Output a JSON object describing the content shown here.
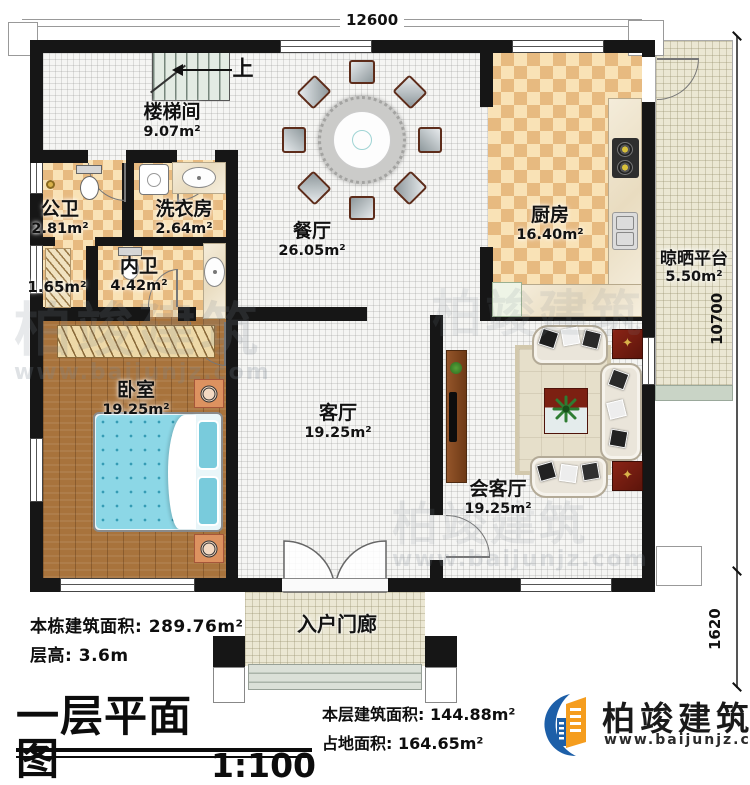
{
  "plan": {
    "title": "一层平面图",
    "scale": "1:100",
    "stairs_up": "上"
  },
  "dimensions": {
    "top": "12600",
    "right": "10700",
    "bottom_right": "1620"
  },
  "rooms": {
    "stairwell": {
      "name": "楼梯间",
      "area": "9.07m²"
    },
    "public_bath": {
      "name": "公卫",
      "area": "2.81m²"
    },
    "laundry": {
      "name": "洗衣房",
      "area": "2.64m²"
    },
    "closet": {
      "area": "1.65m²"
    },
    "ensuite_bath": {
      "name": "内卫",
      "area": "4.42m²"
    },
    "dining": {
      "name": "餐厅",
      "area": "26.05m²"
    },
    "kitchen": {
      "name": "厨房",
      "area": "16.40m²"
    },
    "drying_platform": {
      "name": "晾晒平台",
      "area": "5.50m²"
    },
    "bedroom": {
      "name": "卧室",
      "area": "19.25m²"
    },
    "living": {
      "name": "客厅",
      "area": "19.25m²"
    },
    "reception": {
      "name": "会客厅",
      "area": "19.25m²"
    },
    "porch": {
      "name": "入户门廊"
    }
  },
  "stats": {
    "building_area_label": "本栋建筑面积:",
    "building_area_value": "289.76m²",
    "floor_height_label": "层高:",
    "floor_height_value": "3.6m",
    "floor_area_label": "本层建筑面积:",
    "floor_area_value": "144.88m²",
    "footprint_label": "占地面积:",
    "footprint_value": "164.65m²"
  },
  "brand": {
    "name": "柏竣建筑",
    "url": "www.baijunjz.com"
  },
  "colors": {
    "wall": "#161616",
    "checker_dark": "#e7ba80",
    "checker_light": "#f9e2b6",
    "wood": "#a8733c",
    "bed": "#8cd7e6",
    "logo_blue": "#1d5fa8",
    "logo_orange": "#f59d1e",
    "accent_red": "#7c2012"
  }
}
